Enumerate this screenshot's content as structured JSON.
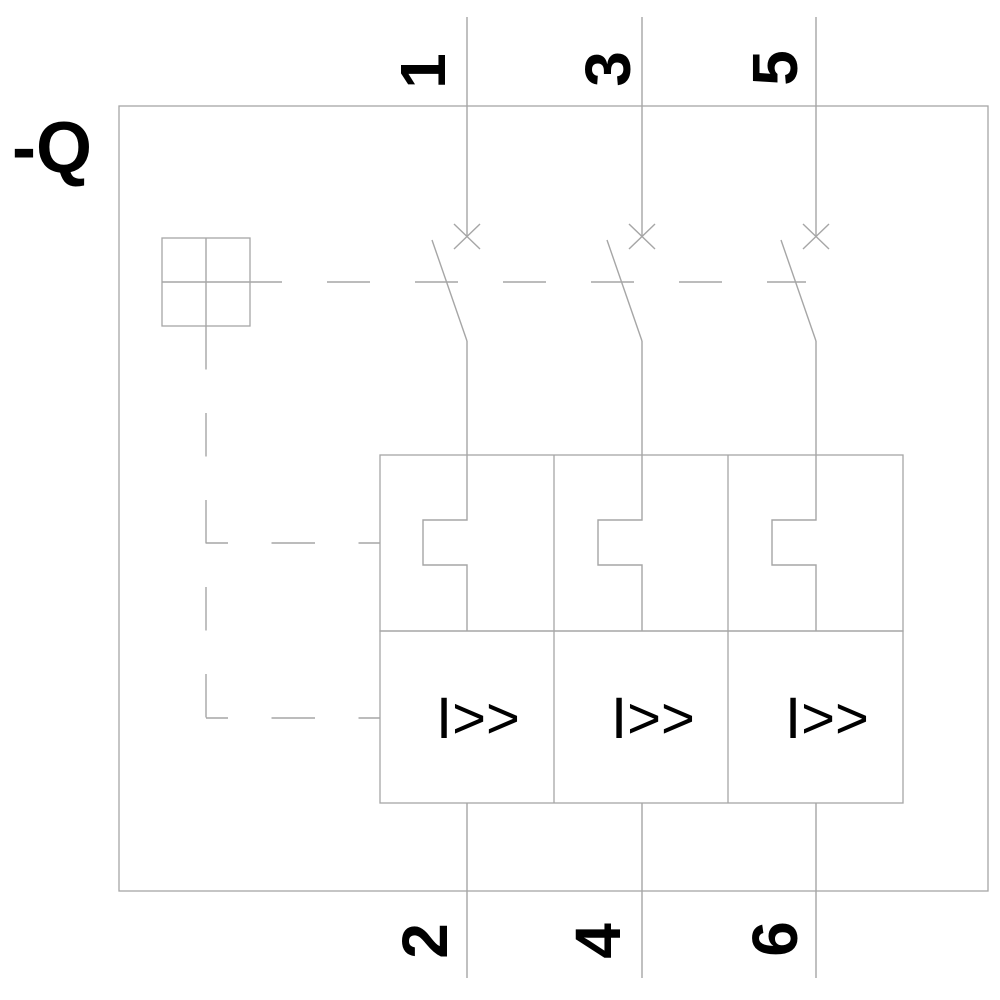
{
  "diagram": {
    "component_label": "-Q",
    "terminals": {
      "top": [
        "1",
        "3",
        "5"
      ],
      "bottom": [
        "2",
        "4",
        "6"
      ]
    },
    "trip_unit_label": "I>>",
    "icons": {
      "actuator": "mechanism-square-cross-icon",
      "contact": "breaker-contact-x-icon",
      "overload": "thermal-overload-notch-symbol",
      "magnetic_trip": "instantaneous-trip-symbol"
    },
    "colors": {
      "line": "#a6a6a6",
      "label": "#000000",
      "background": "#ffffff"
    }
  }
}
